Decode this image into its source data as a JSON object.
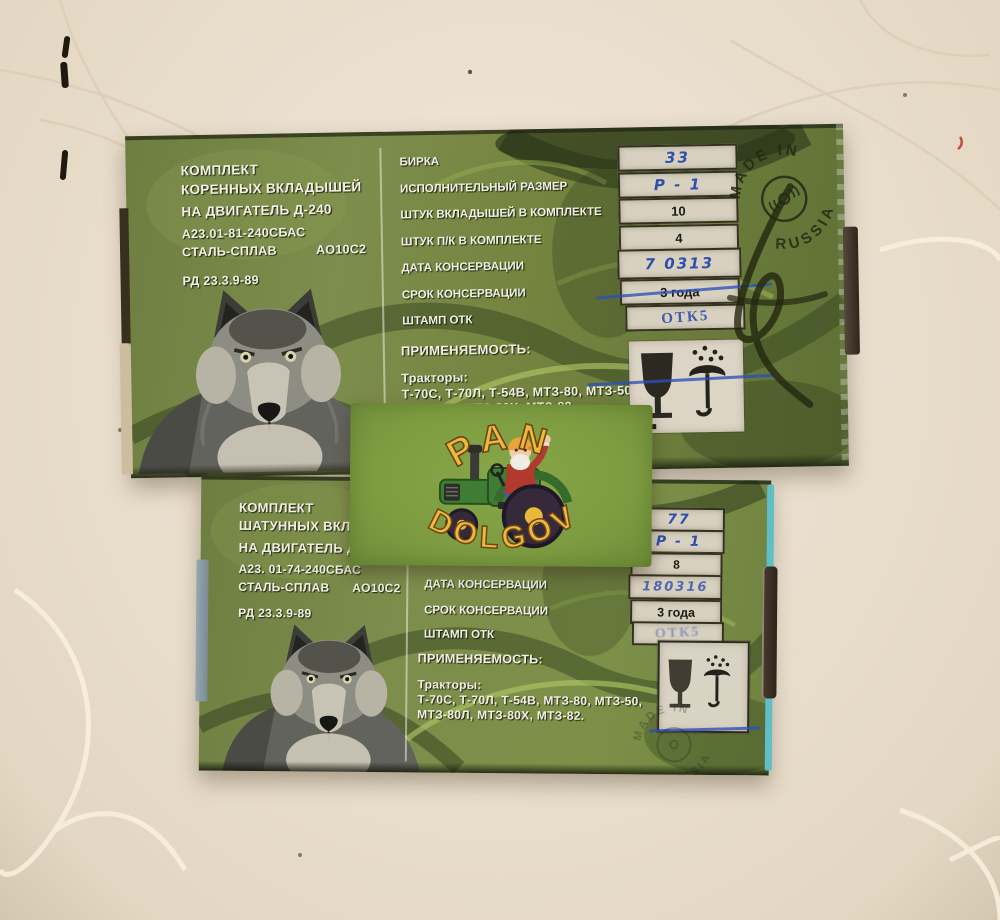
{
  "colors": {
    "background": "#ece1cf",
    "box_green": "#72823f",
    "card_green": "#7fa040",
    "ink_blue": "#2e4fae",
    "teal_edge": "#5fbec6",
    "paper_label": "#d8d1c0"
  },
  "top_box": {
    "title_line1": "КОМПЛЕКТ",
    "title_line2": "КОРЕННЫХ ВКЛАДЫШЕЙ",
    "title_line3": "НА ДВИГАТЕЛЬ   Д-240",
    "part_code": "А23.01-81-240СБАС",
    "material_label": "СТАЛЬ-СПЛАВ",
    "material_grade": "АО10С2",
    "standard_code": "РД 23.3.9-89",
    "rows": [
      {
        "label": "БИРКА",
        "value": "33"
      },
      {
        "label": "ИСПОЛНИТЕЛЬНЫЙ РАЗМЕР",
        "value": "Р - 1"
      },
      {
        "label": "ШТУК ВКЛАДЫШЕЙ В КОМПЛЕКТЕ",
        "value": "10"
      },
      {
        "label": "ШТУК П/К В КОМПЛЕКТЕ",
        "value": "4"
      },
      {
        "label": "ДАТА КОНСЕРВАЦИИ",
        "value": "7 0313"
      },
      {
        "label": "СРОК КОНСЕРВАЦИИ",
        "value": "3 года"
      },
      {
        "label": "ШТАМП ОТК",
        "value": "ОТК5"
      }
    ],
    "application_title": "ПРИМЕНЯЕМОСТЬ:",
    "application_heading": "Тракторы:",
    "application_line1": "Т-70С, Т-70Л, Т-54В, МТЗ-80, МТЗ-50,",
    "application_line2": "МТЗ-80Л, МТЗ-80Х, МТЗ-82.",
    "stamp_top": "MADE IN",
    "stamp_bottom": "RUSSIA"
  },
  "bottom_box": {
    "title_line1": "КОМПЛЕКТ",
    "title_line2": "ШАТУННЫХ ВКЛАД",
    "title_line3": "НА ДВИГАТЕЛЬ   Д",
    "part_code": "А23. 01-74-240СБАС",
    "material_label": "СТАЛЬ-СПЛАВ",
    "material_grade": "АО10С2",
    "standard_code": "РД 23.3.9-89",
    "rows": [
      {
        "label": "",
        "value": "77"
      },
      {
        "label": "",
        "value": "Р - 1"
      },
      {
        "label": "",
        "value": "8"
      },
      {
        "label": "ДАТА КОНСЕРВАЦИИ",
        "value": "180316"
      },
      {
        "label": "СРОК КОНСЕРВАЦИИ",
        "value": "3 года"
      },
      {
        "label": "ШТАМП ОТК",
        "value": "ОТК5"
      }
    ],
    "application_title": "ПРИМЕНЯЕМОСТЬ:",
    "application_heading": "Тракторы:",
    "application_line1": "Т-70С, Т-70Л, Т-54В, МТЗ-80, МТЗ-50,",
    "application_line2": "МТЗ-80Л, МТЗ-80Х, МТЗ-82.",
    "stamp_top": "MADE IN",
    "stamp_bottom": "RUSSIA"
  },
  "card": {
    "line_top": "PAN",
    "line_bottom": "DOLGOV"
  }
}
